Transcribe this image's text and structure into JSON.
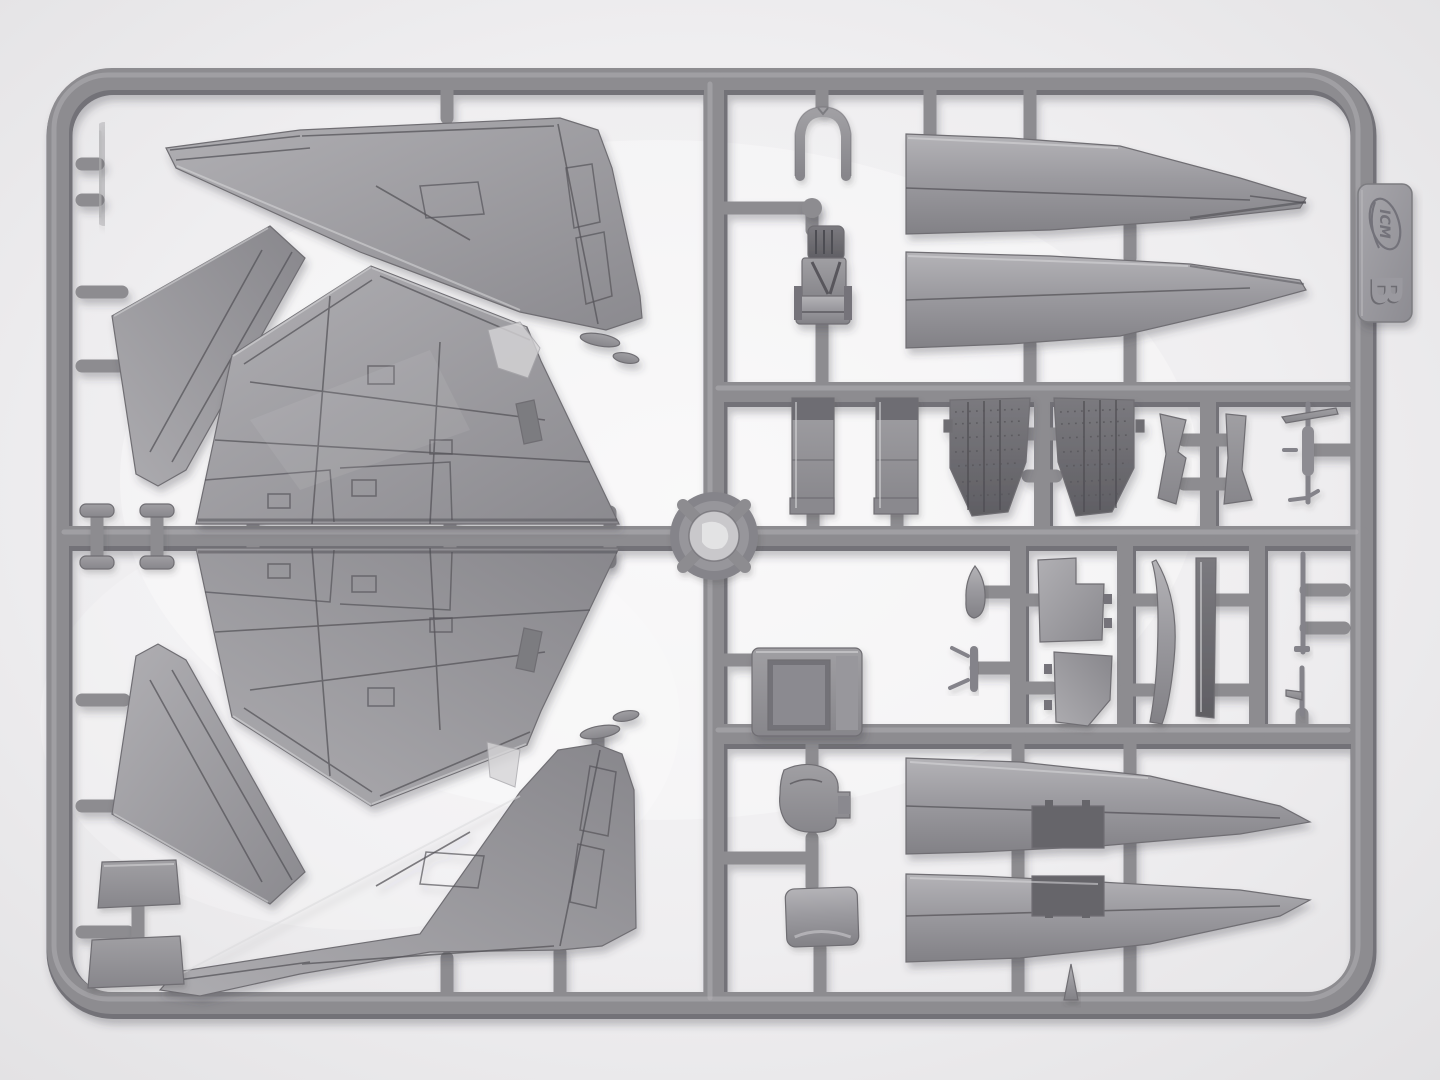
{
  "scene": {
    "type": "photograph",
    "subject": "Injection-molded plastic model kit sprue with aircraft parts on a light box",
    "colors": {
      "bg": "#e7e6e8",
      "bgin": "#f6f5f6",
      "runner": "#8d8c90",
      "runnerdark": "#737278",
      "runnerlight": "#b3b2b6",
      "part": "#a3a2a6",
      "partlight": "#b7b6ba",
      "partdark": "#7c7b80",
      "partdarker": "#636267",
      "panel": "#55545a",
      "shine": "#d9d8da",
      "tag": "#9b9a9f"
    }
  },
  "tag": {
    "brand": "ICM",
    "letter": "B"
  },
  "parts": [
    {
      "id": "fin-upper",
      "label": "vertical tail fin half (upper left)"
    },
    {
      "id": "fin-lower",
      "label": "vertical tail fin half (lower center)"
    },
    {
      "id": "wing-upper",
      "label": "wing half (upper)"
    },
    {
      "id": "wing-lower",
      "label": "wing half (lower)"
    },
    {
      "id": "stab-upper",
      "label": "horizontal stabilizer (upper left)"
    },
    {
      "id": "stab-lower",
      "label": "horizontal stabilizer (lower left)"
    },
    {
      "id": "spine-1",
      "label": "fuselage spine half (top right)"
    },
    {
      "id": "spine-2",
      "label": "fuselage spine half (top right, mirrored)"
    },
    {
      "id": "nacelle-1",
      "label": "lower fuselage nacelle half with bay opening"
    },
    {
      "id": "nacelle-2",
      "label": "lower fuselage nacelle half with bay opening (mirrored)"
    },
    {
      "id": "ejection-seat",
      "label": "ejection seat"
    },
    {
      "id": "canopy-bracket",
      "label": "canopy frame bracket"
    },
    {
      "id": "intake-panel-1",
      "label": "intake duct panel"
    },
    {
      "id": "intake-panel-2",
      "label": "intake duct panel"
    },
    {
      "id": "engine-section-1",
      "label": "riveted engine section"
    },
    {
      "id": "engine-section-2",
      "label": "riveted engine section"
    },
    {
      "id": "actuator-fin-1",
      "label": "small fin / actuator blade"
    },
    {
      "id": "actuator-fin-2",
      "label": "small fin / actuator blade"
    },
    {
      "id": "pitot-probe",
      "label": "pitot probe cruciform"
    },
    {
      "id": "cockpit-tub",
      "label": "cockpit tub box"
    },
    {
      "id": "nose-tip",
      "label": "bullet-shaped fairing tip"
    },
    {
      "id": "valve-part",
      "label": "small pronged fitting"
    },
    {
      "id": "gear-door-1",
      "label": "landing gear door"
    },
    {
      "id": "gear-door-2",
      "label": "landing gear door"
    },
    {
      "id": "strake-1",
      "label": "ventral strake (curved)"
    },
    {
      "id": "strake-2",
      "label": "ventral strake (straight)"
    },
    {
      "id": "antenna-rod",
      "label": "antenna rod"
    },
    {
      "id": "antenna-small",
      "label": "small antenna blade"
    },
    {
      "id": "seat-cushion",
      "label": "seat cushion / bulkhead pad"
    },
    {
      "id": "square-pad",
      "label": "rounded square pad"
    },
    {
      "id": "bracket-pads",
      "label": "twin pad bracket"
    },
    {
      "id": "side-bar",
      "label": "side rail bar"
    },
    {
      "id": "mushroom-caps",
      "label": "four mushroom cap plugs"
    },
    {
      "id": "cone-small",
      "label": "small cone tip"
    },
    {
      "id": "gate-hub",
      "label": "central sprue gate hub"
    }
  ]
}
